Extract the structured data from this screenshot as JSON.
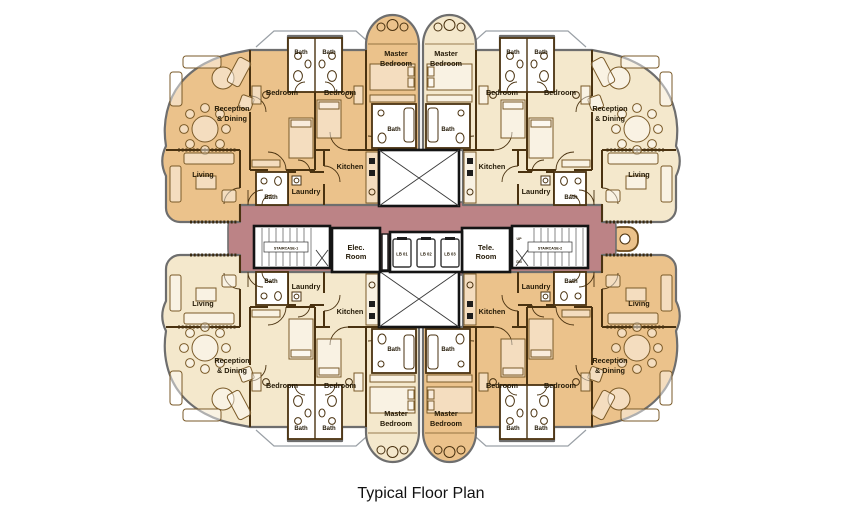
{
  "caption": "Typical Floor Plan",
  "palette": {
    "background": "#ffffff",
    "unit_tan": "#ebc28b",
    "unit_cream": "#f4e8cc",
    "corridor": "#bc8386",
    "wall": "#4a3210",
    "core_wall": "#141414",
    "outer_wall": "#6e6e6e"
  },
  "rooms": {
    "bedroom": "Bedroom",
    "master_l1": "Master",
    "master_l2": "Bedroom",
    "bath": "Bath",
    "kitchen": "Kitchen",
    "laundry": "Laundry",
    "living": "Living",
    "reception_l1": "Reception",
    "reception_l2": "& Dining",
    "elec_l1": "Elec.",
    "elec_l2": "Room",
    "tele_l1": "Tele.",
    "tele_l2": "Room",
    "staircase1": "STAIRCASE-1",
    "staircase2": "STAIRCASE-2",
    "up": "UP",
    "dn": "DN",
    "lifts": [
      "LB 01",
      "LB 02",
      "LB 03"
    ]
  }
}
